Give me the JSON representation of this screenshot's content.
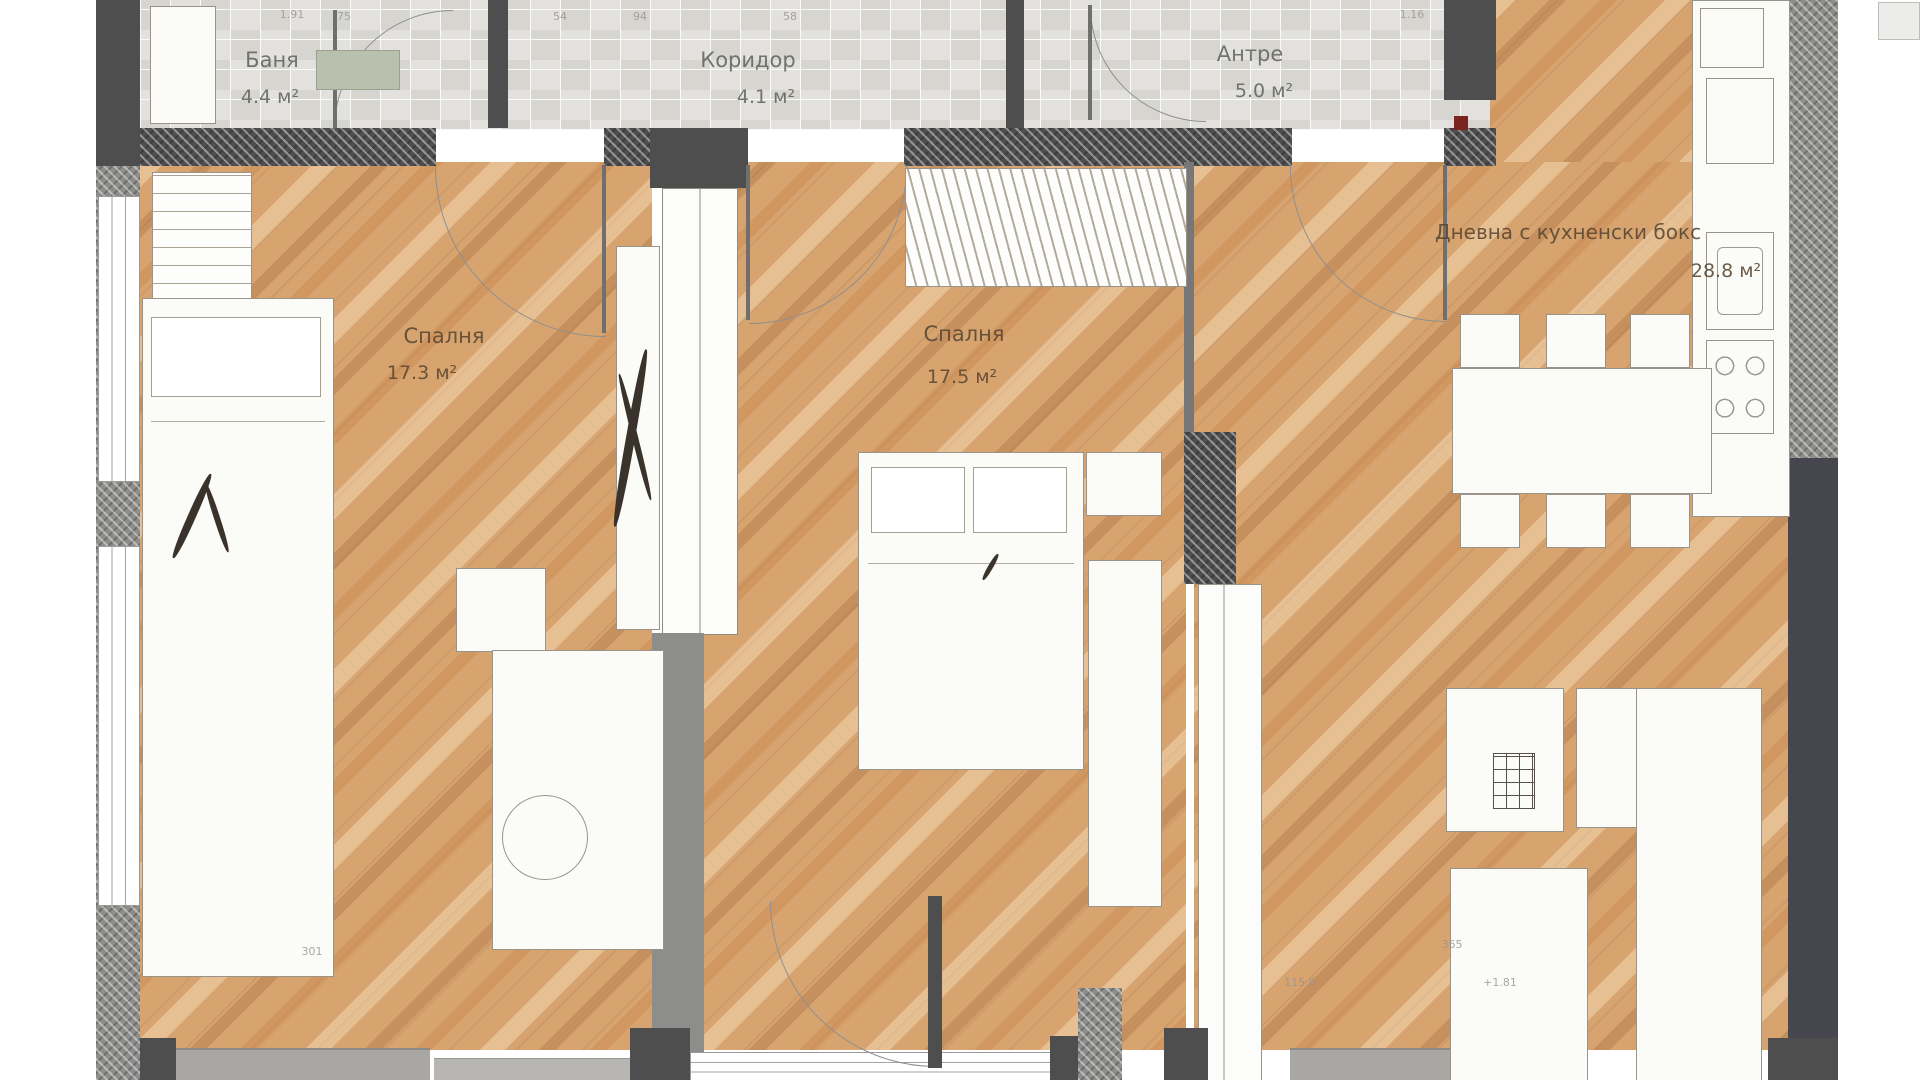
{
  "type": "apartment-floor-plan",
  "language": "bg",
  "rooms": [
    {
      "id": "bathroom",
      "name": "Баня",
      "area": "4.4 м²"
    },
    {
      "id": "corridor",
      "name": "Коридор",
      "area": "4.1 м²"
    },
    {
      "id": "entry",
      "name": "Антре",
      "area": "5.0 м²"
    },
    {
      "id": "bedroom1",
      "name": "Спалня",
      "area": "17.3 м²"
    },
    {
      "id": "bedroom2",
      "name": "Спалня",
      "area": "17.5 м²"
    },
    {
      "id": "living",
      "name": "Дневна с кухненски бокс",
      "area": "28.8 м²"
    }
  ],
  "dimensions": [
    "1.91",
    "75",
    "54",
    "94",
    "58",
    "1.16",
    "301",
    "365",
    "+1.81",
    "115.0"
  ],
  "colors": {
    "wood": "#d7a470",
    "wood-dark": "#b9834c",
    "tile": "#e2e1dd",
    "tile-dark": "#d6d5d0",
    "wall": "#4e4e4e",
    "wall-mid": "#8d8d8b",
    "furniture": "#fbfbf8",
    "furniture-border": "#9a9389",
    "label": "#5a4733",
    "label-gray": "#63635f",
    "accent-red": "#7c2420"
  }
}
